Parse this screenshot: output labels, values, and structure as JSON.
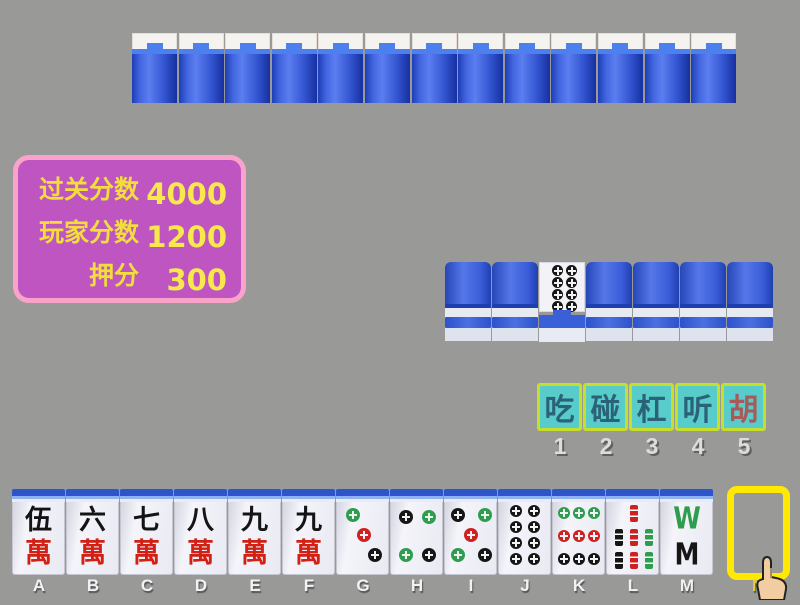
{
  "window": {
    "background": "#999998"
  },
  "score_panel": {
    "rows": [
      {
        "label": "过关分数",
        "value": "4000"
      },
      {
        "label": "玩家分数",
        "value": "1200"
      },
      {
        "label": "押分",
        "value": "300"
      }
    ],
    "colors": {
      "bg": "#bf55c0",
      "border": "#f9a3cb",
      "label_text": "#f1de3d",
      "value_text": "#f7e84b"
    }
  },
  "opponent_row": {
    "tile_count": 13,
    "tile": "face-down-back"
  },
  "meld_row": {
    "tiles": [
      {
        "type": "back"
      },
      {
        "type": "back"
      },
      {
        "type": "circle",
        "value": 8,
        "name": "8-circles"
      },
      {
        "type": "back"
      },
      {
        "type": "back"
      },
      {
        "type": "back"
      },
      {
        "type": "back"
      }
    ]
  },
  "action_bar": {
    "buttons": [
      {
        "label": "吃",
        "hotkey": "1",
        "text_color": "#2b6277"
      },
      {
        "label": "碰",
        "hotkey": "2",
        "text_color": "#2b6277"
      },
      {
        "label": "杠",
        "hotkey": "3",
        "text_color": "#2b6277"
      },
      {
        "label": "听",
        "hotkey": "4",
        "text_color": "#2b6277"
      },
      {
        "label": "胡",
        "hotkey": "5",
        "text_color": "#a85a5a"
      }
    ],
    "colors": {
      "bg": "#57cccb",
      "border": "#c6df2b",
      "hotkey_text": "#dddddd"
    }
  },
  "hand": {
    "tiles": [
      {
        "letter": "A",
        "suit": "wan",
        "value": 5,
        "char_top": "伍",
        "char_bottom": "萬"
      },
      {
        "letter": "B",
        "suit": "wan",
        "value": 6,
        "char_top": "六",
        "char_bottom": "萬"
      },
      {
        "letter": "C",
        "suit": "wan",
        "value": 7,
        "char_top": "七",
        "char_bottom": "萬"
      },
      {
        "letter": "D",
        "suit": "wan",
        "value": 8,
        "char_top": "八",
        "char_bottom": "萬"
      },
      {
        "letter": "E",
        "suit": "wan",
        "value": 9,
        "char_top": "九",
        "char_bottom": "萬"
      },
      {
        "letter": "F",
        "suit": "wan",
        "value": 9,
        "char_top": "九",
        "char_bottom": "萬"
      },
      {
        "letter": "G",
        "suit": "circle",
        "value": 3
      },
      {
        "letter": "H",
        "suit": "circle",
        "value": 4
      },
      {
        "letter": "I",
        "suit": "circle",
        "value": 5
      },
      {
        "letter": "J",
        "suit": "circle",
        "value": 8
      },
      {
        "letter": "K",
        "suit": "circle",
        "value": 9
      },
      {
        "letter": "L",
        "suit": "bamboo",
        "value": 7
      },
      {
        "letter": "M",
        "suit": "bamboo",
        "value": 8
      }
    ],
    "draw_slot": {
      "letter": "N",
      "border_color": "#ffe903",
      "empty": true
    }
  },
  "cursor": {
    "icon": "pointing-hand-cursor"
  },
  "tile_palette": {
    "dot_black": "#161616",
    "dot_green": "#2e9e4e",
    "dot_red": "#ce2222",
    "wan_red": "#d32015",
    "char_black": "#141414",
    "back_blue": "#2d54ca"
  }
}
